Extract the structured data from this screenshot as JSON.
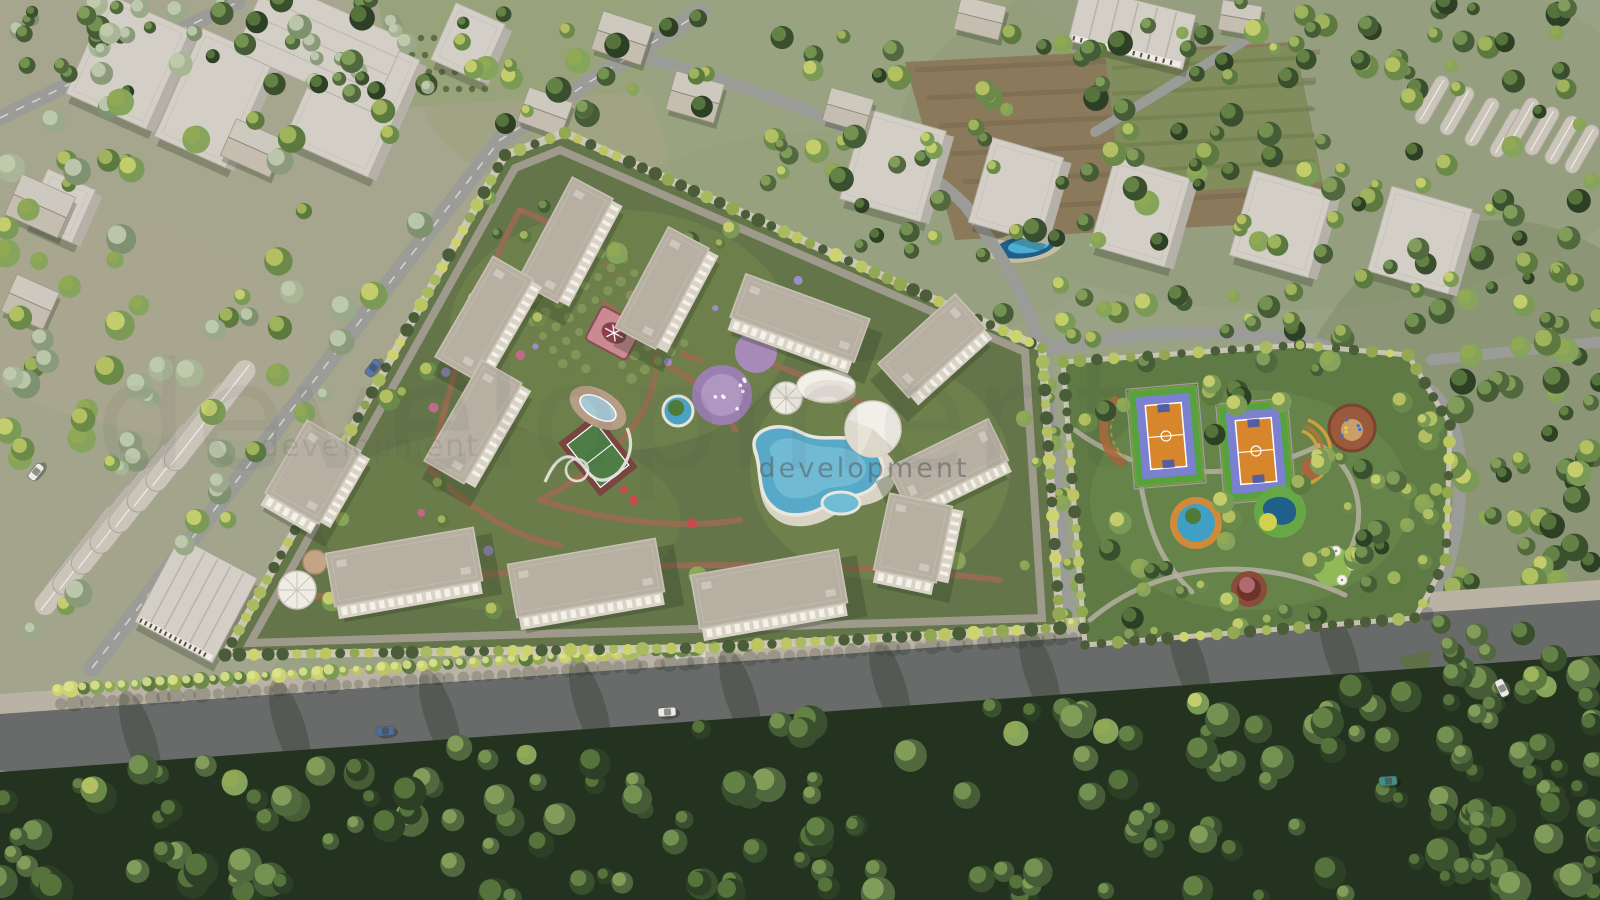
{
  "meta": {
    "description": "Bird's-eye 3D architectural rendering of a gated residential complex with landscaped gardens, pools and an adjacent sports park, surrounded by roads, greenhouses, fields and forest"
  },
  "watermark": {
    "text": "development"
  },
  "palette": {
    "base": "#9aa286",
    "tan": "#b0a893",
    "olive": "#99a37b",
    "field_brown": "#8a795b",
    "field_olive": "#7f8f5c",
    "field_stripe": "#6f5f45",
    "road": "#9b9b97",
    "road_dark": "#686b69",
    "sidewalk": "#bab2a5",
    "shoulder": "#8e918c",
    "wall": "#d0cabd",
    "inner_road": "#a49e93",
    "roof": "#b6afa2",
    "roof_edge": "#c9c3b6",
    "facade": "#d9d3c7",
    "facade_shade": "#aaa295",
    "window": "#f5f2eb",
    "shadow": "#2f3a26",
    "block": "#d3cfc6",
    "block_side": "#b5b1a8",
    "house_roof": "#c4bdb0",
    "red_roof": "#8a5a48",
    "greenhouse": "#cac4b9",
    "greenhouse_dark": "#a9a399",
    "forest": "#24331f",
    "tree_dark": [
      "#2d4026",
      "#3a4f2d",
      "#455c36",
      "#52683f"
    ],
    "tree_mid": [
      "#5c7a40",
      "#6b8a4a",
      "#7a9a55",
      "#87a45d"
    ],
    "tree_sage": [
      "#8b9a7a",
      "#9aa98a",
      "#7e9270",
      "#a9b696"
    ],
    "tree_bright": [
      "#a9bb60",
      "#bcc764",
      "#cdd46f",
      "#93a853"
    ],
    "bush_dark": "#4a5c38",
    "path": "#9c6b52",
    "plaza": "#b07a5f",
    "pool": "#58a9c7",
    "pool_light": "#82c6da",
    "deck": "#ded7c9",
    "pond_deck": "#b79d86",
    "pond_water": "#a9cad5",
    "court_green": "#55a23e",
    "court_blue": "#7b80cf",
    "court_orange": "#d8862b",
    "court_maroon": "#7a4540",
    "court_field": "#4e7d46",
    "purple": "#9a7fb0",
    "purple_light": "#b29ac4",
    "pink": "#c98a92",
    "pink_dark": "#8a3f4d",
    "canopy": "#f3f0e9",
    "canopy_shade": "#d9d4c8",
    "ring_orange": "#cf8a3a",
    "planter_red": "#8a4b3a",
    "planter_core": "#6e3328",
    "lawn": "#8fba57",
    "pond_green": "#67a846",
    "pond_deep": "#1f5f8a",
    "flower_yellow": "#cfd14f",
    "track": "#a8683c",
    "amphi": "#d9a23a",
    "watermark": "#585c60",
    "car_blue": "#4a6f9e",
    "car_white": "#eceae4",
    "car_teal": "#3f8f86",
    "car_blue2": "#5577aa"
  },
  "scene": {
    "residential_complex": {
      "label": "walled residential complex",
      "apartment_building_count": 12,
      "amenities": [
        "free-form swimming pool",
        "kids pool",
        "oval garden pond",
        "tree pool",
        "tennis court",
        "purple playground",
        "fountain plaza",
        "lattice gazebo",
        "round canopy",
        "pavilion tent",
        "orchard garden",
        "slide track"
      ]
    },
    "sports_park": {
      "label": "landscaped sports park",
      "features": [
        "two orange multi-sport courts",
        "ring pool with tree",
        "green pond",
        "tree planter",
        "lawn circle",
        "parasol terrace",
        "playground circles",
        "running track arc",
        "amphitheater steps"
      ]
    },
    "context": {
      "features": [
        "grey massing blocks",
        "gabled houses",
        "greenhouse rows",
        "farm fields",
        "small pond",
        "dense forest belt",
        "road network"
      ]
    },
    "vehicles": {
      "count": 6,
      "colors": [
        "#4a6f9e",
        "#eceae4",
        "#eceae4",
        "#3f8f86",
        "#5577aa",
        "#eceae4"
      ]
    }
  }
}
